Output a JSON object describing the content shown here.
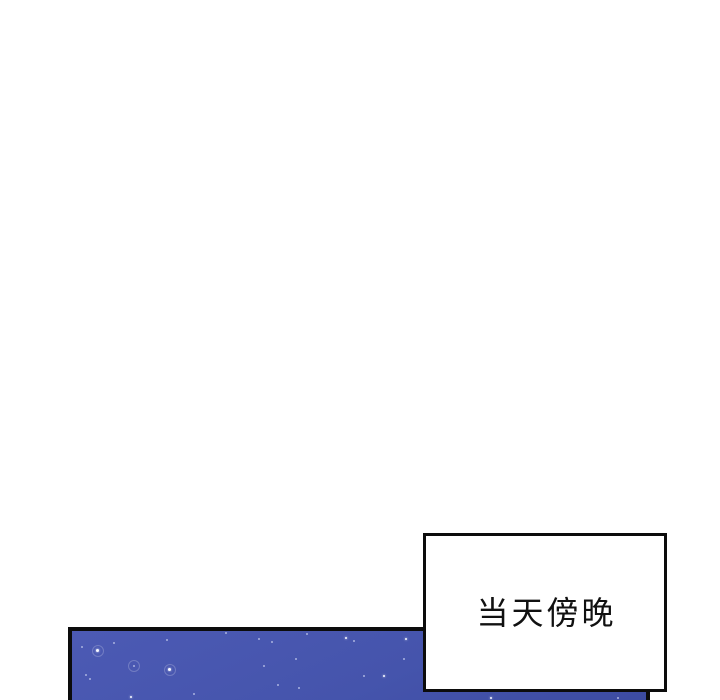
{
  "page": {
    "background": "#ffffff"
  },
  "colors": {
    "line": "#0c0c0c",
    "ink": "#111111"
  },
  "caption": {
    "text": "当天傍晚",
    "text_color": "#111111",
    "box_background": "#ffffff",
    "border_color": "#0c0c0c"
  },
  "panel": {
    "kind": "night-sky",
    "border_color": "#0c0c0c",
    "sky_top_color": "#4c5ab4",
    "sky_mid_color": "#4554ac",
    "sky_bottom_color": "#3c4ba1",
    "stars": [
      {
        "x": 9,
        "y": 15,
        "s": 2,
        "b": "dim"
      },
      {
        "x": 24,
        "y": 18,
        "s": 3,
        "b": "bright",
        "halo": true
      },
      {
        "x": 41,
        "y": 11,
        "s": 2,
        "b": "dim"
      },
      {
        "x": 61,
        "y": 34,
        "s": 2,
        "b": "dim",
        "halo": true
      },
      {
        "x": 94,
        "y": 8,
        "s": 2,
        "b": "dim"
      },
      {
        "x": 96,
        "y": 37,
        "s": 3,
        "b": "bright",
        "halo": true
      },
      {
        "x": 13,
        "y": 43,
        "s": 2,
        "b": "dim"
      },
      {
        "x": 17,
        "y": 47,
        "s": 2,
        "b": "dim"
      },
      {
        "x": 58,
        "y": 65,
        "s": 2,
        "b": "bright"
      },
      {
        "x": 121,
        "y": 62,
        "s": 2,
        "b": "dim"
      },
      {
        "x": 153,
        "y": 1,
        "s": 2,
        "b": "dim"
      },
      {
        "x": 186,
        "y": 7,
        "s": 2,
        "b": "dim"
      },
      {
        "x": 199,
        "y": 10,
        "s": 2,
        "b": "dim"
      },
      {
        "x": 223,
        "y": 27,
        "s": 2,
        "b": "dim"
      },
      {
        "x": 191,
        "y": 34,
        "s": 2,
        "b": "dim"
      },
      {
        "x": 205,
        "y": 53,
        "s": 2,
        "b": "dim"
      },
      {
        "x": 226,
        "y": 56,
        "s": 2,
        "b": "dim"
      },
      {
        "x": 234,
        "y": 2,
        "s": 2,
        "b": "dim"
      },
      {
        "x": 273,
        "y": 6,
        "s": 2,
        "b": "bright"
      },
      {
        "x": 281,
        "y": 9,
        "s": 2,
        "b": "dim"
      },
      {
        "x": 291,
        "y": 44,
        "s": 2,
        "b": "dim"
      },
      {
        "x": 311,
        "y": 44,
        "s": 2,
        "b": "bright"
      },
      {
        "x": 333,
        "y": 7,
        "s": 2,
        "b": "bright"
      },
      {
        "x": 331,
        "y": 27,
        "s": 2,
        "b": "dim"
      },
      {
        "x": 418,
        "y": 66,
        "s": 2,
        "b": "bright"
      },
      {
        "x": 545,
        "y": 66,
        "s": 2,
        "b": "dim"
      }
    ]
  }
}
